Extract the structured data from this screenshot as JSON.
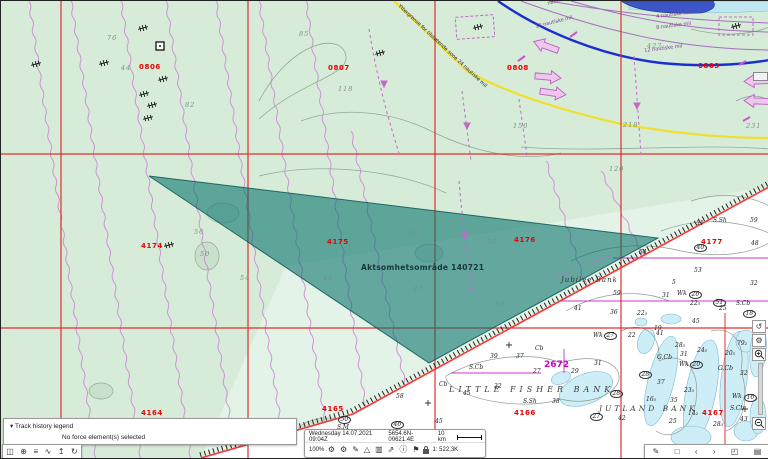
{
  "map": {
    "area_overlay": {
      "label": "Aktsomhetsområde 140721"
    },
    "red_labels": [
      {
        "t": "0806",
        "x": 138,
        "y": 63
      },
      {
        "t": "0807",
        "x": 327,
        "y": 64
      },
      {
        "t": "0808",
        "x": 506,
        "y": 64
      },
      {
        "t": "0809",
        "x": 697,
        "y": 62
      },
      {
        "t": "4174",
        "x": 140,
        "y": 242
      },
      {
        "t": "4175",
        "x": 326,
        "y": 238
      },
      {
        "t": "4176",
        "x": 513,
        "y": 236
      },
      {
        "t": "4177",
        "x": 700,
        "y": 238
      },
      {
        "t": "4164",
        "x": 140,
        "y": 409
      },
      {
        "t": "4165",
        "x": 321,
        "y": 405
      },
      {
        "t": "4166",
        "x": 513,
        "y": 409
      },
      {
        "t": "4167",
        "x": 701,
        "y": 409
      }
    ],
    "green_depths": [
      {
        "t": "76",
        "x": 106,
        "y": 34
      },
      {
        "t": "44",
        "x": 120,
        "y": 64
      },
      {
        "t": "82",
        "x": 184,
        "y": 101
      },
      {
        "t": "85",
        "x": 298,
        "y": 30
      },
      {
        "t": "118",
        "x": 337,
        "y": 85
      },
      {
        "t": "427",
        "x": 646,
        "y": 42
      },
      {
        "t": "218",
        "x": 622,
        "y": 121
      },
      {
        "t": "150",
        "x": 512,
        "y": 122
      },
      {
        "t": "231",
        "x": 745,
        "y": 122
      },
      {
        "t": "120",
        "x": 608,
        "y": 165
      },
      {
        "t": "56",
        "x": 193,
        "y": 228
      },
      {
        "t": "50",
        "x": 199,
        "y": 250
      },
      {
        "t": "53",
        "x": 407,
        "y": 230
      },
      {
        "t": "56",
        "x": 486,
        "y": 238
      },
      {
        "t": "44",
        "x": 322,
        "y": 274
      },
      {
        "t": "37",
        "x": 412,
        "y": 285
      },
      {
        "t": "45",
        "x": 494,
        "y": 300
      },
      {
        "t": "54",
        "x": 239,
        "y": 274
      }
    ],
    "boundary_texts": [
      {
        "t": "Yttergrense for tilstøtende sone 24 nautiske mil",
        "x": 399,
        "y": 3,
        "rot": 43,
        "purple": false
      },
      {
        "t": "nautiske mil",
        "x": 546,
        "y": 1,
        "rot": -16,
        "purple": true
      },
      {
        "t": "12 nautiske mil",
        "x": 534,
        "y": 24,
        "rot": -14,
        "purple": true
      },
      {
        "t": "4 nautiske mil",
        "x": 655,
        "y": 14,
        "rot": -7,
        "purple": true
      },
      {
        "t": "8 nautiske mil",
        "x": 655,
        "y": 25,
        "rot": -7,
        "purple": true
      },
      {
        "t": "12 nautiske mil",
        "x": 643,
        "y": 48,
        "rot": -7,
        "purple": true
      }
    ],
    "chart_names": [
      {
        "t": "Jubilee Bank",
        "x": 560,
        "y": 276,
        "cls": "nm-small"
      },
      {
        "t": "LITTLE FISHER BANK",
        "x": 448,
        "y": 385,
        "cls": "nm-bank"
      },
      {
        "t": "JUTLAND BANK",
        "x": 598,
        "y": 404,
        "cls": "nm-bank2"
      },
      {
        "t": "2672",
        "x": 543,
        "y": 360,
        "cls": "nm-chartno"
      }
    ],
    "soundings": [
      {
        "t": "Wk",
        "x": 592,
        "y": 332
      },
      {
        "t": "27",
        "x": 603,
        "y": 331,
        "c": 1
      },
      {
        "t": "22",
        "x": 627,
        "y": 332
      },
      {
        "t": "41",
        "x": 655,
        "y": 330
      },
      {
        "t": "28₅",
        "x": 674,
        "y": 342
      },
      {
        "t": "24₅",
        "x": 696,
        "y": 347
      },
      {
        "t": "79₂",
        "x": 736,
        "y": 340
      },
      {
        "t": "20₅",
        "x": 724,
        "y": 350
      },
      {
        "t": "G.Cb",
        "x": 656,
        "y": 354
      },
      {
        "t": "31",
        "x": 679,
        "y": 351
      },
      {
        "t": "Wk",
        "x": 678,
        "y": 361
      },
      {
        "t": "20",
        "x": 689,
        "y": 360,
        "c": 1
      },
      {
        "t": "G.Cb",
        "x": 717,
        "y": 365
      },
      {
        "t": "32",
        "x": 739,
        "y": 370
      },
      {
        "t": "39",
        "x": 489,
        "y": 353
      },
      {
        "t": "37",
        "x": 515,
        "y": 353
      },
      {
        "t": "Cb",
        "x": 534,
        "y": 345
      },
      {
        "t": "S.Cb",
        "x": 468,
        "y": 364
      },
      {
        "t": "27",
        "x": 532,
        "y": 368
      },
      {
        "t": "29",
        "x": 570,
        "y": 368
      },
      {
        "t": "31",
        "x": 593,
        "y": 360
      },
      {
        "t": "28",
        "x": 638,
        "y": 370,
        "c": 1
      },
      {
        "t": "37",
        "x": 656,
        "y": 379
      },
      {
        "t": "32",
        "x": 493,
        "y": 383
      },
      {
        "t": "Cb",
        "x": 438,
        "y": 381
      },
      {
        "t": "45",
        "x": 462,
        "y": 390
      },
      {
        "t": "S.Sh",
        "x": 522,
        "y": 398
      },
      {
        "t": "38",
        "x": 551,
        "y": 398
      },
      {
        "t": "28",
        "x": 609,
        "y": 389,
        "c": 1
      },
      {
        "t": "23₅",
        "x": 683,
        "y": 387
      },
      {
        "t": "35",
        "x": 669,
        "y": 397
      },
      {
        "t": "16₅",
        "x": 645,
        "y": 396
      },
      {
        "t": "Wk",
        "x": 731,
        "y": 393
      },
      {
        "t": "16",
        "x": 743,
        "y": 393,
        "c": 1
      },
      {
        "t": "S.Cb",
        "x": 729,
        "y": 405
      },
      {
        "t": "27",
        "x": 589,
        "y": 412,
        "c": 1
      },
      {
        "t": "42",
        "x": 617,
        "y": 415
      },
      {
        "t": "25",
        "x": 668,
        "y": 418
      },
      {
        "t": "14₂",
        "x": 687,
        "y": 410
      },
      {
        "t": "43",
        "x": 739,
        "y": 416
      },
      {
        "t": "28₃",
        "x": 712,
        "y": 421
      },
      {
        "t": "51",
        "x": 695,
        "y": 220
      },
      {
        "t": "S.Sh",
        "x": 712,
        "y": 217
      },
      {
        "t": "59",
        "x": 749,
        "y": 217
      },
      {
        "t": "40",
        "x": 693,
        "y": 243,
        "c": 1
      },
      {
        "t": "48",
        "x": 750,
        "y": 240
      },
      {
        "t": "54",
        "x": 638,
        "y": 249
      },
      {
        "t": "53",
        "x": 693,
        "y": 267
      },
      {
        "t": "5",
        "x": 671,
        "y": 279
      },
      {
        "t": "32",
        "x": 749,
        "y": 280
      },
      {
        "t": "59",
        "x": 612,
        "y": 290
      },
      {
        "t": "31",
        "x": 661,
        "y": 292
      },
      {
        "t": "Wk",
        "x": 676,
        "y": 290
      },
      {
        "t": "26",
        "x": 688,
        "y": 290,
        "c": 1
      },
      {
        "t": "22₅",
        "x": 689,
        "y": 300
      },
      {
        "t": "51",
        "x": 712,
        "y": 298,
        "c": 1
      },
      {
        "t": "25",
        "x": 718,
        "y": 305
      },
      {
        "t": "S.Cb",
        "x": 735,
        "y": 300
      },
      {
        "t": "18",
        "x": 742,
        "y": 309,
        "c": 1
      },
      {
        "t": "41",
        "x": 573,
        "y": 305
      },
      {
        "t": "36",
        "x": 609,
        "y": 309
      },
      {
        "t": "22₅",
        "x": 636,
        "y": 310
      },
      {
        "t": "45",
        "x": 691,
        "y": 318
      },
      {
        "t": "19",
        "x": 653,
        "y": 325
      },
      {
        "t": "50",
        "x": 337,
        "y": 415,
        "c": 1
      },
      {
        "t": "S.M",
        "x": 336,
        "y": 424
      },
      {
        "t": "58",
        "x": 395,
        "y": 393
      },
      {
        "t": "46",
        "x": 390,
        "y": 420,
        "c": 1
      },
      {
        "t": "45",
        "x": 434,
        "y": 418
      },
      {
        "t": "35",
        "x": 454,
        "y": 452
      }
    ],
    "wrecks": [
      [
        142,
        27
      ],
      [
        35,
        63
      ],
      [
        103,
        62
      ],
      [
        162,
        78
      ],
      [
        143,
        93
      ],
      [
        151,
        104
      ],
      [
        147,
        117
      ],
      [
        379,
        52
      ],
      [
        477,
        26
      ],
      [
        735,
        25
      ],
      [
        168,
        244
      ]
    ]
  },
  "legend_panel": {
    "caret": "▾",
    "title": "Track history legend",
    "message": "No force element(s) selected"
  },
  "status_bar": {
    "datetime": "Wednesday 14.07.2021 09:04Z",
    "position": "5654.6N-00621.4E",
    "scale_distance": "10 km",
    "zoom_percent": "100%",
    "scale_ratio": "1: 522,3K",
    "icons": [
      {
        "name": "settings-gear-icon",
        "g": "⚙"
      },
      {
        "name": "settings-gear2-icon",
        "g": "⚙"
      },
      {
        "name": "edit-pencil-icon",
        "g": "✎"
      },
      {
        "name": "warning-triangle-icon",
        "g": "△"
      },
      {
        "name": "chart-bars-icon",
        "g": "▥"
      },
      {
        "name": "export-icon",
        "g": "⇗"
      },
      {
        "name": "info-icon",
        "g": "ⓘ"
      },
      {
        "name": "flag-icon",
        "g": "⚑"
      }
    ]
  },
  "left_toolbar": {
    "icons": [
      {
        "name": "chart-portfolio-icon",
        "g": "◫"
      },
      {
        "name": "globe-icon",
        "g": "⊕"
      },
      {
        "name": "menu-list-icon",
        "g": "≡"
      },
      {
        "name": "route-icon",
        "g": "∿"
      },
      {
        "name": "upload-anchor-icon",
        "g": "↥"
      },
      {
        "name": "refresh-icon",
        "g": "↻"
      }
    ]
  },
  "br_toolbar": {
    "icons": [
      {
        "name": "annotate-pen-icon",
        "g": "✎"
      },
      {
        "name": "bookmark-icon",
        "g": "□"
      },
      {
        "name": "prev-icon",
        "g": "‹"
      },
      {
        "name": "next-icon",
        "g": "›"
      },
      {
        "name": "fullscreen-icon",
        "g": "◰"
      },
      {
        "name": "chart-page-icon",
        "g": "▤"
      }
    ]
  },
  "right_controls": {
    "rotate": {
      "name": "rotate-view-icon",
      "g": "↺"
    },
    "gear": {
      "name": "map-settings-icon",
      "g": "⚙"
    },
    "zoom_in": "+",
    "zoom_out": "−"
  }
}
